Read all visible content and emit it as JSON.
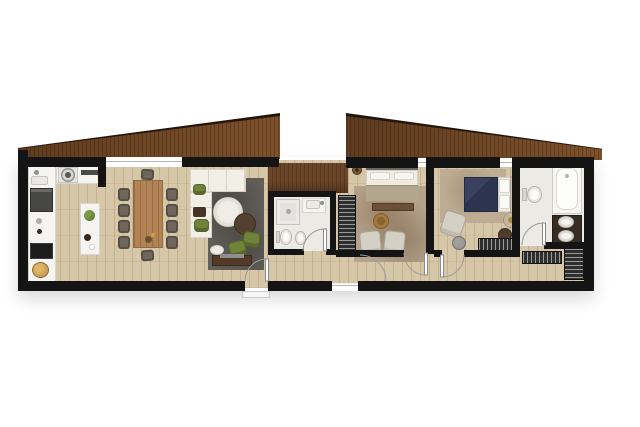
{
  "app": {
    "type": "architectural-floor-plan",
    "style": "top-down color render, no text labels"
  },
  "palette": {
    "background": "#ffffff",
    "wall": "#141414",
    "floor": "#d6c7a8",
    "floor_line": "rgba(146,113,72,0.25)",
    "tile": "#ebeae5",
    "roof_wood_dark": "#5e3c1f",
    "roof_wood_light": "#7d512b",
    "roof_edge": "#24150b",
    "roof_grain": "rgba(35,18,6,0.28)",
    "band": "#6b4628",
    "counter": "#f5f4f0",
    "appliance_dark": "#474745",
    "rug_gray": "#63605a",
    "rug_tan": "#b4a28b",
    "rug_tan2": "#bdac93",
    "sofa": "#f2efe7",
    "sofa_line": "#d8d3c6",
    "green": "#71833a",
    "table_wood": "#b28355",
    "chair": "#575046",
    "chair_inner": "#6f675c",
    "navy": "#2d3450",
    "bed_white": "#efece4",
    "wardrobe": "#2e2e2e",
    "wardrobe_stripe": "#9a9a98",
    "console": "#523a27",
    "brown_table": "#54402f",
    "brass": "#a57a3e",
    "vanity": "#352c23",
    "door_arc": "#9b9b9b",
    "window_line": "#b5b5b5",
    "step": "#f7f7f7"
  },
  "rooms": [
    {
      "name": "kitchen-dining-living",
      "features": [
        "wall kitchen counter with sink, fridge, hob, basket",
        "top counter with round burner and oven drawer",
        "kitchen island with plant",
        "dining table with 10 chairs",
        "L-shaped white sofa with green poufs",
        "round coffee table pair",
        "2 green armchairs",
        "tv console",
        "dark gray rug"
      ]
    },
    {
      "name": "central-bathroom",
      "features": [
        "shower",
        "washbasin",
        "toilet",
        "bidet",
        "door"
      ]
    },
    {
      "name": "bedroom-1",
      "features": [
        "double bed with bench",
        "brass round table",
        "2 beige armchairs",
        "striped wardrobe",
        "ceiling lamp",
        "tan rug"
      ]
    },
    {
      "name": "master-bedroom",
      "features": [
        "double bed with navy duvet",
        "armchair",
        "round pouf",
        "2 side tables",
        "striped wardrobe",
        "rug"
      ]
    },
    {
      "name": "master-bathroom",
      "features": [
        "toilet",
        "bathtub",
        "double-sink vanity",
        "door"
      ]
    },
    {
      "name": "hallway-and-closet",
      "features": [
        "corridor",
        "2 striped wardrobes",
        "entry doors with swing arcs"
      ]
    }
  ],
  "counts": {
    "dining_chairs": 10,
    "roof_sections": 2,
    "bathrooms": 2,
    "bedrooms": 2,
    "vanity_sinks": 2,
    "door_arcs": 6
  }
}
